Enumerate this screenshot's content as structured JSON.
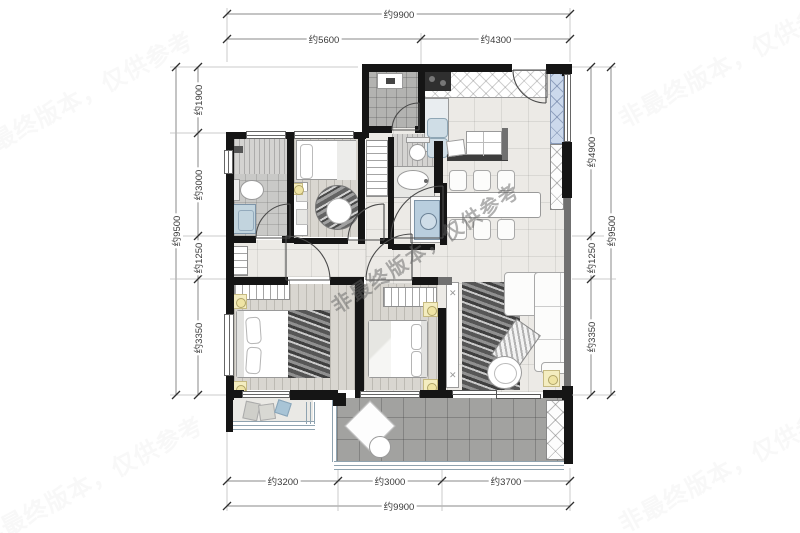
{
  "watermark": {
    "center_text": "非最终版本，仅供参考"
  },
  "dimensions": {
    "top": {
      "total": "约9900",
      "seg1": "约5600",
      "seg2": "约4300"
    },
    "bottom": {
      "total": "约9900",
      "seg1": "约3200",
      "seg2": "约3000",
      "seg3": "约3700"
    },
    "left": {
      "total": "约9500",
      "seg1": "约1900",
      "seg2": "约3000",
      "seg3": "约1250",
      "seg4": "约3350"
    },
    "right": {
      "total": "约9500",
      "seg1": "约4900",
      "seg2": "约1250",
      "seg3": "约3350"
    }
  },
  "colors": {
    "wall": "#151515",
    "lamp_accent": "#f4edc0",
    "appliance_blue": "#b9cede",
    "balcony_floor": "#a2a2a0"
  },
  "icons": {
    "cabinet_cross": "✕"
  }
}
